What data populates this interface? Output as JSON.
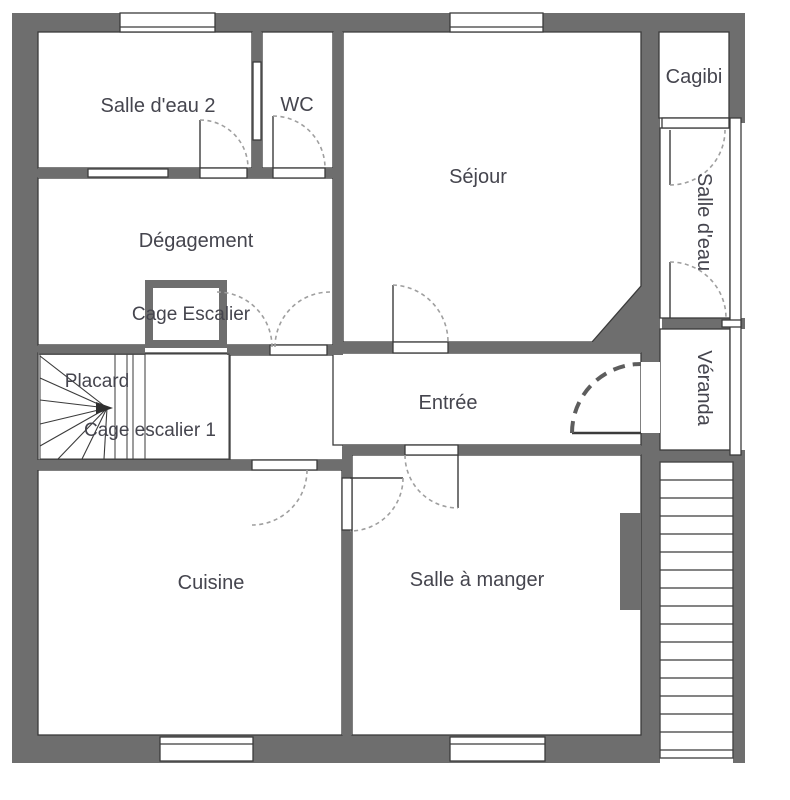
{
  "plan": {
    "type": "floor-plan",
    "language": "fr",
    "rooms": [
      {
        "id": "salle-deau-2",
        "label": "Salle d'eau 2"
      },
      {
        "id": "wc",
        "label": "WC"
      },
      {
        "id": "sejour",
        "label": "Séjour"
      },
      {
        "id": "cagibi",
        "label": "Cagibi"
      },
      {
        "id": "salle-deau",
        "label": "Salle d'eau"
      },
      {
        "id": "degagement",
        "label": "Dégagement"
      },
      {
        "id": "cage-escalier",
        "label": "Cage Escalier"
      },
      {
        "id": "veranda",
        "label": "Véranda"
      },
      {
        "id": "placard",
        "label": "Placard"
      },
      {
        "id": "entree",
        "label": "Entrée"
      },
      {
        "id": "cage-escalier-1",
        "label": "Cage escalier 1"
      },
      {
        "id": "cuisine",
        "label": "Cuisine"
      },
      {
        "id": "salle-a-manger",
        "label": "Salle à manger"
      }
    ],
    "colors": {
      "wall": "#6e6e6e",
      "line": "#3b3b3b",
      "door_swing": "#9f9f9f",
      "entrance_swing": "#5d5d5d",
      "label_text": "#45454e",
      "background": "#ffffff"
    }
  }
}
